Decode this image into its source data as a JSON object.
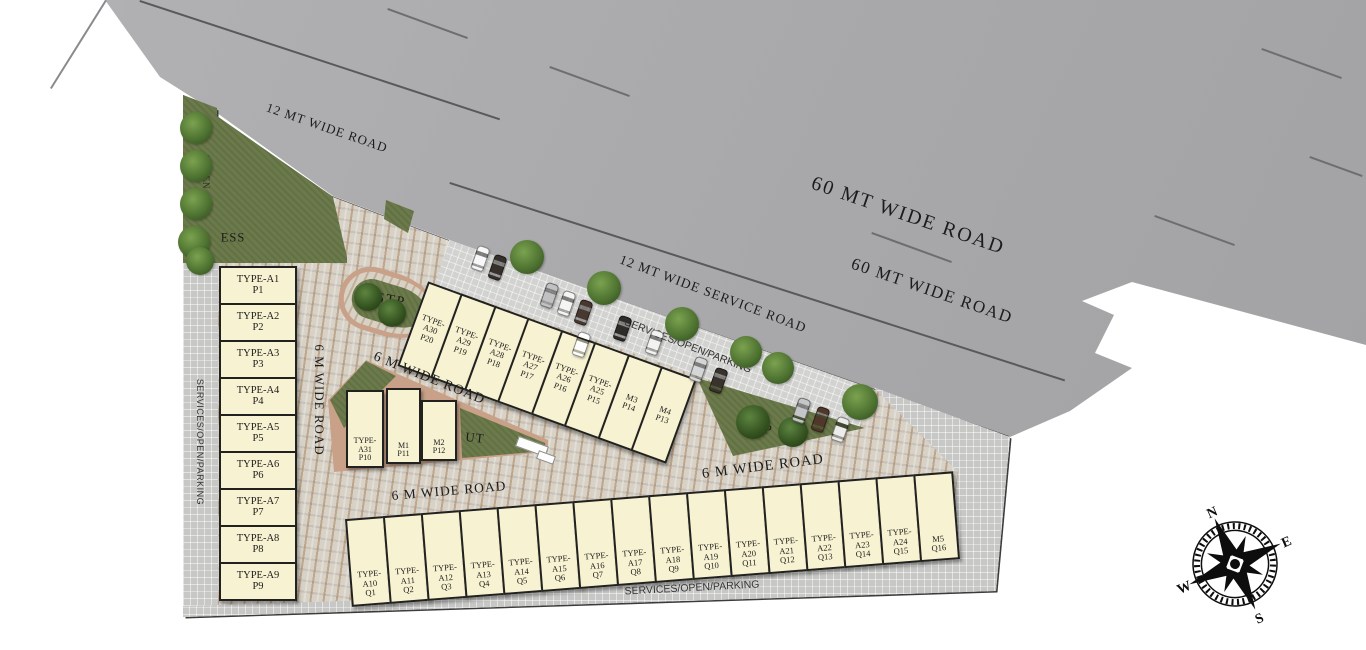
{
  "roads": {
    "r12": "12 MT WIDE ROAD",
    "r60a": "60 MT WIDE ROAD",
    "r60b": "60 MT WIDE ROAD",
    "service": "12 MT WIDE SERVICE ROAD",
    "r6_vertical": "6 M WIDE ROAD",
    "r6_upper": "6 M WIDE ROAD",
    "r6_lower": "6 M WIDE ROAD",
    "r6_right": "6 M WIDE ROAD"
  },
  "areas": {
    "green_belt": "GREEN",
    "ess": "ESS",
    "stp": "STP",
    "wtp": "WTP",
    "ut": "UT",
    "services_left": "SERVICES/OPEN/PARKING",
    "services_top": "SERVICES/OPEN/PARKING",
    "services_bottom": "SERVICES/OPEN/PARKING"
  },
  "compass": {
    "north": "N",
    "east": "E",
    "south": "S",
    "west": "W"
  },
  "plots": {
    "left_column": [
      {
        "type": "TYPE-A1",
        "number": "P1"
      },
      {
        "type": "TYPE-A2",
        "number": "P2"
      },
      {
        "type": "TYPE-A3",
        "number": "P3"
      },
      {
        "type": "TYPE-A4",
        "number": "P4"
      },
      {
        "type": "TYPE-A5",
        "number": "P5"
      },
      {
        "type": "TYPE-A6",
        "number": "P6"
      },
      {
        "type": "TYPE-A7",
        "number": "P7"
      },
      {
        "type": "TYPE-A8",
        "number": "P8"
      },
      {
        "type": "TYPE-A9",
        "number": "P9"
      }
    ],
    "middle_row": [
      {
        "type": "TYPE-A30",
        "number": "P20"
      },
      {
        "type": "TYPE-A29",
        "number": "P19"
      },
      {
        "type": "TYPE-A28",
        "number": "P18"
      },
      {
        "type": "TYPE-A27",
        "number": "P17"
      },
      {
        "type": "TYPE-A26",
        "number": "P16"
      },
      {
        "type": "TYPE-A25",
        "number": "P15"
      },
      {
        "type": "M3",
        "number": "P14"
      },
      {
        "type": "M4",
        "number": "P13"
      }
    ],
    "inner_block": [
      {
        "type": "TYPE-A31",
        "number": "P10"
      },
      {
        "type": "M1",
        "number": "P11"
      },
      {
        "type": "M2",
        "number": "P12"
      }
    ],
    "bottom_row": [
      {
        "type": "TYPE-A10",
        "number": "Q1"
      },
      {
        "type": "TYPE-A11",
        "number": "Q2"
      },
      {
        "type": "TYPE-A12",
        "number": "Q3"
      },
      {
        "type": "TYPE-A13",
        "number": "Q4"
      },
      {
        "type": "TYPE-A14",
        "number": "Q5"
      },
      {
        "type": "TYPE-A15",
        "number": "Q6"
      },
      {
        "type": "TYPE-A16",
        "number": "Q7"
      },
      {
        "type": "TYPE-A17",
        "number": "Q8"
      },
      {
        "type": "TYPE-A18",
        "number": "Q9"
      },
      {
        "type": "TYPE-A19",
        "number": "Q10"
      },
      {
        "type": "TYPE-A20",
        "number": "Q11"
      },
      {
        "type": "TYPE-A21",
        "number": "Q12"
      },
      {
        "type": "TYPE-A22",
        "number": "Q13"
      },
      {
        "type": "TYPE-A23",
        "number": "Q14"
      },
      {
        "type": "TYPE-A24",
        "number": "Q15"
      },
      {
        "type": "M5",
        "number": "Q16"
      }
    ]
  },
  "parking": {
    "car_colors": [
      "#f8f8f8",
      "#35302b",
      "#bfc1c3",
      "#f5f5f3",
      "#473830",
      "#fdfdfd",
      "#2f2b28",
      "#f2f2f0",
      "#d5d6d8",
      "#3a322c",
      "#c4c6c8",
      "#50372a",
      "#ececea"
    ]
  },
  "icons": {
    "tree": "tree-icon",
    "car": "car-icon",
    "compass": "compass-rose-icon",
    "gate": "entrance-gate-icon"
  },
  "colors": {
    "road_grey": "#a8a8aa",
    "plot_fill": "#f7f2d2",
    "plot_border": "#21211f",
    "green": "#6b7a4a",
    "curb": "#c9a189",
    "paving": "#d7d1c6",
    "grid_grey": "#c7c7c6"
  }
}
